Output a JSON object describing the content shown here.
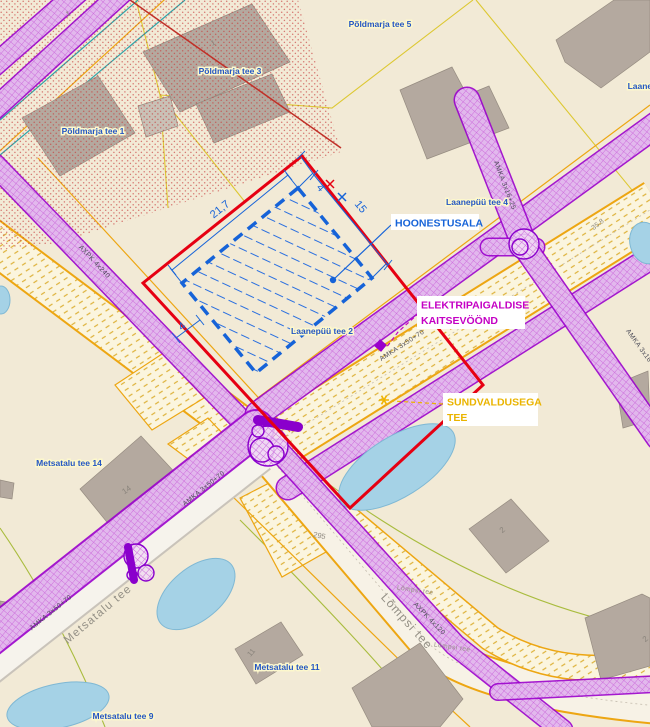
{
  "annotations": {
    "hoonestusala": "HOONESTUSALA",
    "kaitsevoond_line1": "ELEKTRIPAIGALDISE",
    "kaitsevoond_line2": "KAITSEVÖÖND",
    "sundvaldus_line1": "SUNDVALDUSEGA",
    "sundvaldus_line2": "TEE"
  },
  "dimensions": {
    "width_m": "21,7",
    "depth_m": "15",
    "setback_m": "4"
  },
  "addresses": [
    "Põldmarja tee 5",
    "Põldmarja tee 3",
    "Põldmarja tee 1",
    "Laanepüü tee",
    "Laanepüü tee 4",
    "Laanepüü tee 2",
    "Metsatalu tee 14",
    "Metsatalu tee 11",
    "Metsatalu tee 9"
  ],
  "roads": {
    "metsatalu": "Metsatalu tee",
    "lompsi": "Lõmpsi tee"
  },
  "cables": {
    "amka_small": "AMKA 3x16+25",
    "amka_main": "AMKA 3x50+70",
    "axpk_240": "AXPK 4x240",
    "axpk_120": "AXPK 4x120"
  },
  "measurements": {
    "road_width": "35.8",
    "parcel_no": "295"
  },
  "building_numbers": {
    "n1a": "1",
    "n1b": "1",
    "n14": "14",
    "n11": "11",
    "n2a": "2",
    "n2b": "2"
  },
  "colors": {
    "boundary_red": "#e60012",
    "hoonestusala_blue": "#1663d8",
    "kaitsevoond_magenta": "#c400c4",
    "sundvaldus_yellow": "#eab400",
    "corridor_purple": "#9a00cc",
    "address_blue": "#2456c4",
    "background_beige": "#f2ead6"
  }
}
